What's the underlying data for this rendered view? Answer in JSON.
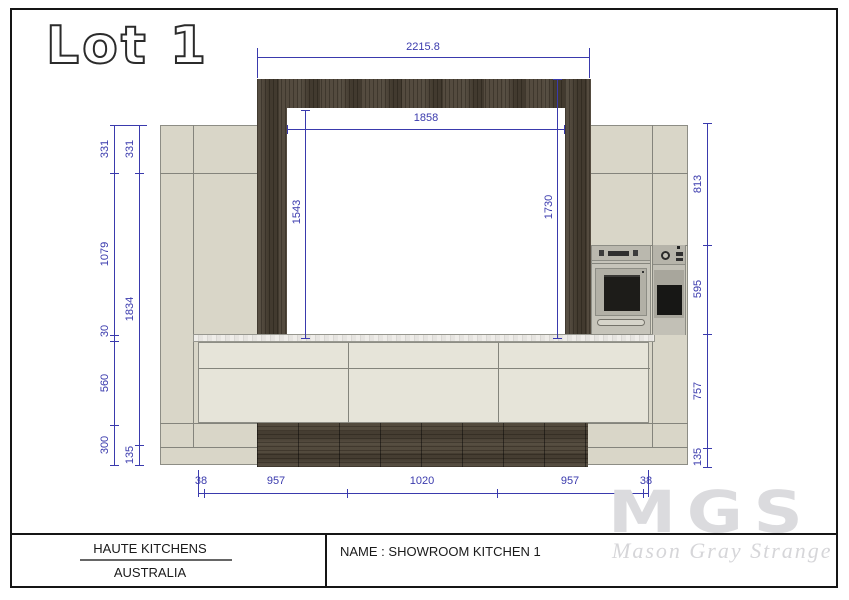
{
  "page": {
    "lot_label": "Lot 1"
  },
  "title_block": {
    "company_line1": "HAUTE KITCHENS",
    "company_line2": "AUSTRALIA",
    "drawing_name": "NAME : SHOWROOM KITCHEN 1"
  },
  "watermark": {
    "logo_text": "MGS",
    "tagline": "Mason Gray Strange"
  },
  "colors": {
    "dimension_blue": "#3a3aad",
    "wood_dark": "#4d4437",
    "cabinet_beige": "#d9d6c8",
    "drawer_front": "#e6e4d9",
    "watermark_gray": "#dbdbde"
  },
  "dimensions": {
    "top_outer_width": "2215.8",
    "opening_width": "1858",
    "opening_height_left": "1543",
    "opening_height_right": "1730",
    "left_inner_chain": [
      "331",
      "1079",
      "30",
      "560",
      "300"
    ],
    "left_outer_chain": [
      "331",
      "1834",
      "135"
    ],
    "right_chain": [
      "813",
      "595",
      "757",
      "135"
    ],
    "bottom_chain": [
      "38",
      "957",
      "1020",
      "957",
      "38"
    ]
  }
}
